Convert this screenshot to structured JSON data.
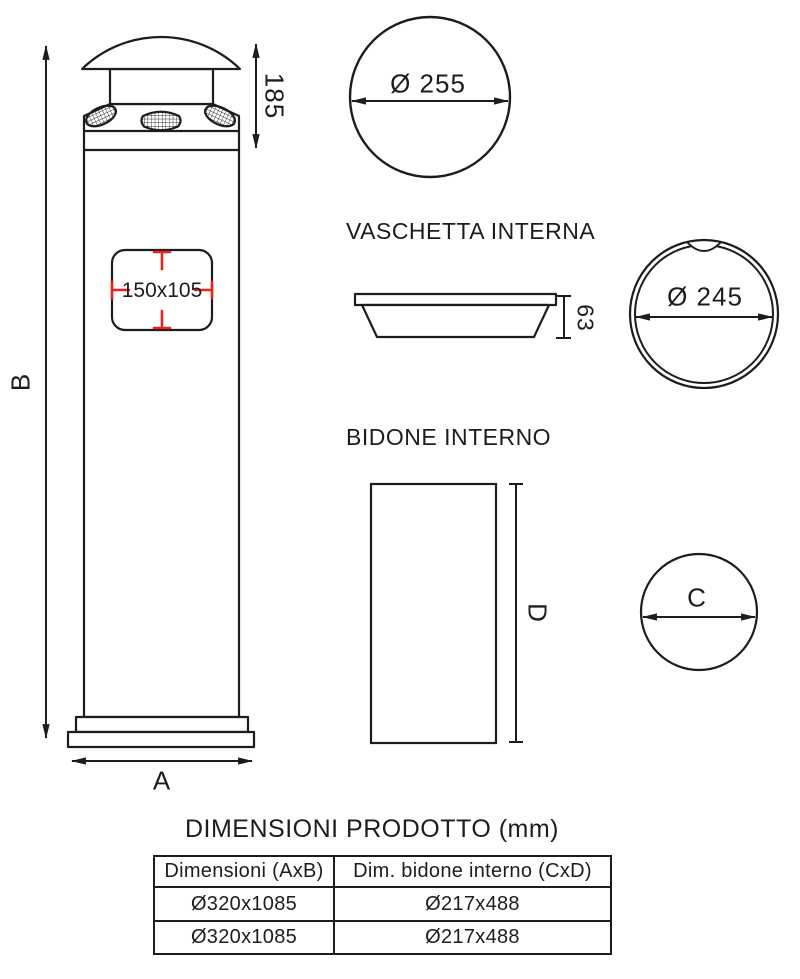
{
  "drawing": {
    "labels": {
      "overall_height": "B",
      "overall_width": "A",
      "head_height": "185",
      "opening_size": "150x105",
      "top_diameter": "Ø 255",
      "tray_height": "63",
      "tray_diameter": "Ø 245",
      "bin_diameter": "C",
      "bin_height": "D"
    },
    "sections": {
      "tray_title": "VASCHETTA INTERNA",
      "bin_title": "BIDONE INTERNO"
    },
    "colors": {
      "line": "#1d1d1b",
      "dimension_mark_red": "#e8231a"
    }
  },
  "table": {
    "title": "DIMENSIONI PRODOTTO (mm)",
    "headers": [
      "Dimensioni (AxB)",
      "Dim. bidone interno (CxD)"
    ],
    "rows": [
      [
        "Ø320x1085",
        "Ø217x488"
      ],
      [
        "Ø320x1085",
        "Ø217x488"
      ]
    ]
  }
}
